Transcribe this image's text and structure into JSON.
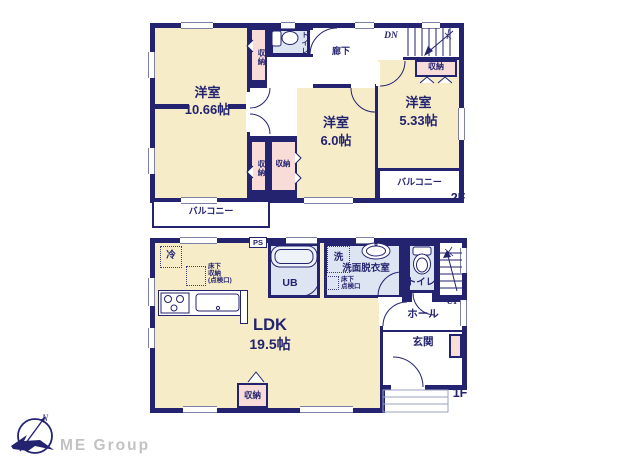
{
  "floor2": {
    "room_large": {
      "name": "洋室",
      "size": "10.66帖"
    },
    "room_mid": {
      "name": "洋室",
      "size": "6.0帖"
    },
    "room_small": {
      "name": "洋室",
      "size": "5.33帖"
    },
    "toilet": "トイレ",
    "corridor": "廊下",
    "stairs_down": "DN",
    "closet": "収納",
    "balcony": "バルコニー",
    "floor_label": "2F"
  },
  "floor1": {
    "ldk": {
      "name": "LDK",
      "size": "19.5帖"
    },
    "unit_bath": "UB",
    "washroom": "洗面脱衣室",
    "washer": "洗",
    "toilet": "トイレ",
    "hall": "ホール",
    "entrance": "玄関",
    "stairs_up": "UP",
    "pipe_space": "PS",
    "fridge": "冷",
    "closet": "収納",
    "underfloor_storage": "床下\n収納\n(点検口)",
    "underfloor_hatch": "床下\n点検口",
    "floor_label": "1F"
  },
  "logo": {
    "company": "ME Group",
    "north": "N"
  },
  "colors": {
    "wall": "#232370",
    "room": "#f6ecc8",
    "closet": "#f8dcd8",
    "wet": "#dde5f2"
  }
}
